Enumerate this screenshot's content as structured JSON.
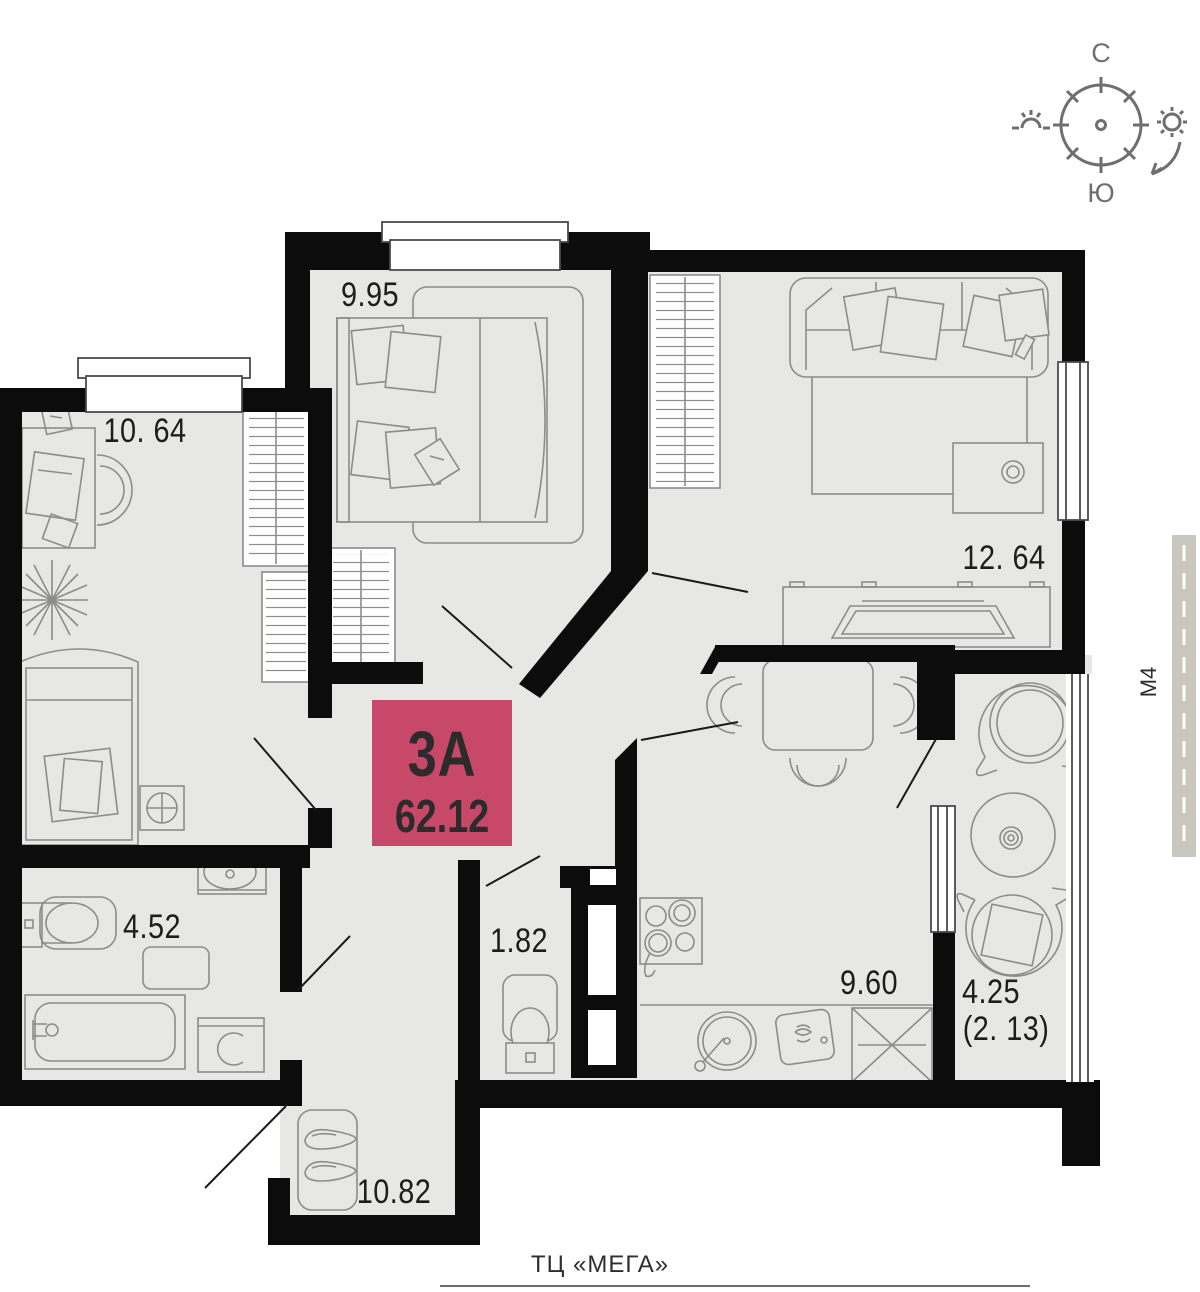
{
  "plan": {
    "kind": "apartment floor plan",
    "unit": {
      "type_label": "3А",
      "total_area": "62.12"
    },
    "rooms": [
      {
        "id": "bedroom",
        "area": "9.95"
      },
      {
        "id": "kids-room",
        "area": "10. 64"
      },
      {
        "id": "living-room",
        "area": "12. 64"
      },
      {
        "id": "bathroom",
        "area": "4.52"
      },
      {
        "id": "wc",
        "area": "1.82"
      },
      {
        "id": "kitchen",
        "area": "9.60"
      },
      {
        "id": "balcony",
        "area": "4.25",
        "area_reduced": "(2. 13)"
      },
      {
        "id": "hallway",
        "area": "10.82"
      }
    ],
    "compass": {
      "north": "С",
      "south": "Ю"
    },
    "landmarks": {
      "road": "М4",
      "mall": "ТЦ «МЕГА»"
    },
    "colors": {
      "accent": "#c8486a",
      "wall": "#0c0c0c",
      "floor": "#e7e7e6",
      "furniture_line": "#8c8c8c",
      "road": "#cac7c0",
      "compass": "#6f6f6f",
      "label_text": "#1d1d1d"
    }
  }
}
